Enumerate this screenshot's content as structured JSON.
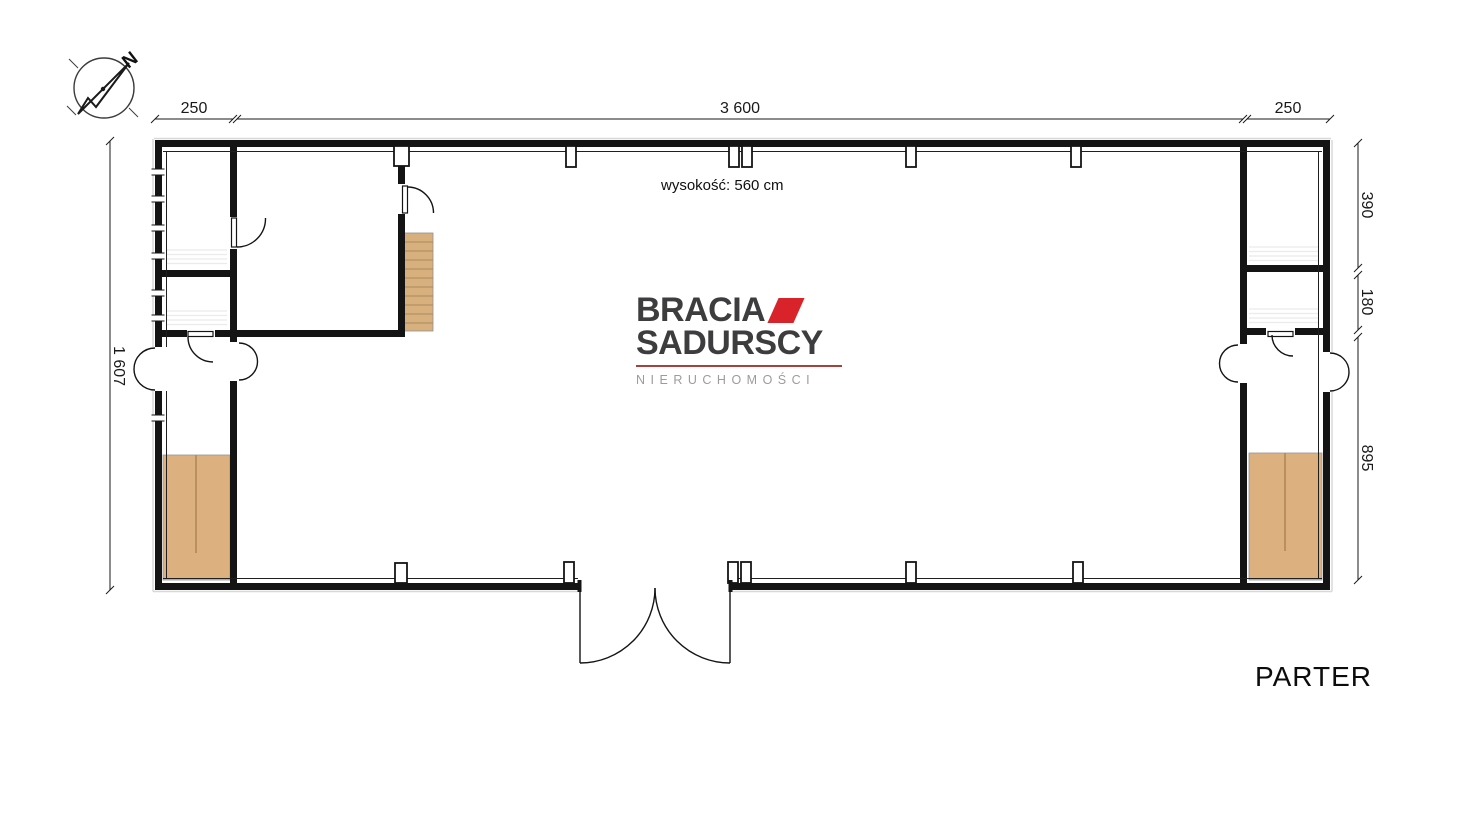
{
  "plan": {
    "floor_label": "PARTER",
    "height_note": "wysokość: 560 cm"
  },
  "logo": {
    "brand_line1": "BRACIA",
    "brand_line2": "SADURSCY",
    "brand_tagline": "NIERUCHOMOŚCI",
    "accent_color": "#d8232a",
    "text_color": "#3d3d3f",
    "tagline_color": "#9c9c9c"
  },
  "compass": {
    "north_label": "N"
  },
  "dimensions": {
    "top_left_width": "250",
    "top_hall_width": "3 600",
    "top_right_width": "250",
    "left_total_height": "1 607",
    "right_room_upper": "390",
    "right_room_middle": "180",
    "right_corridor": "895"
  },
  "colors": {
    "wall": "#141414",
    "wood_floor": "#ddb080",
    "stair_wood": "#d8b07e",
    "dimension_text": "#1a1a1a"
  }
}
